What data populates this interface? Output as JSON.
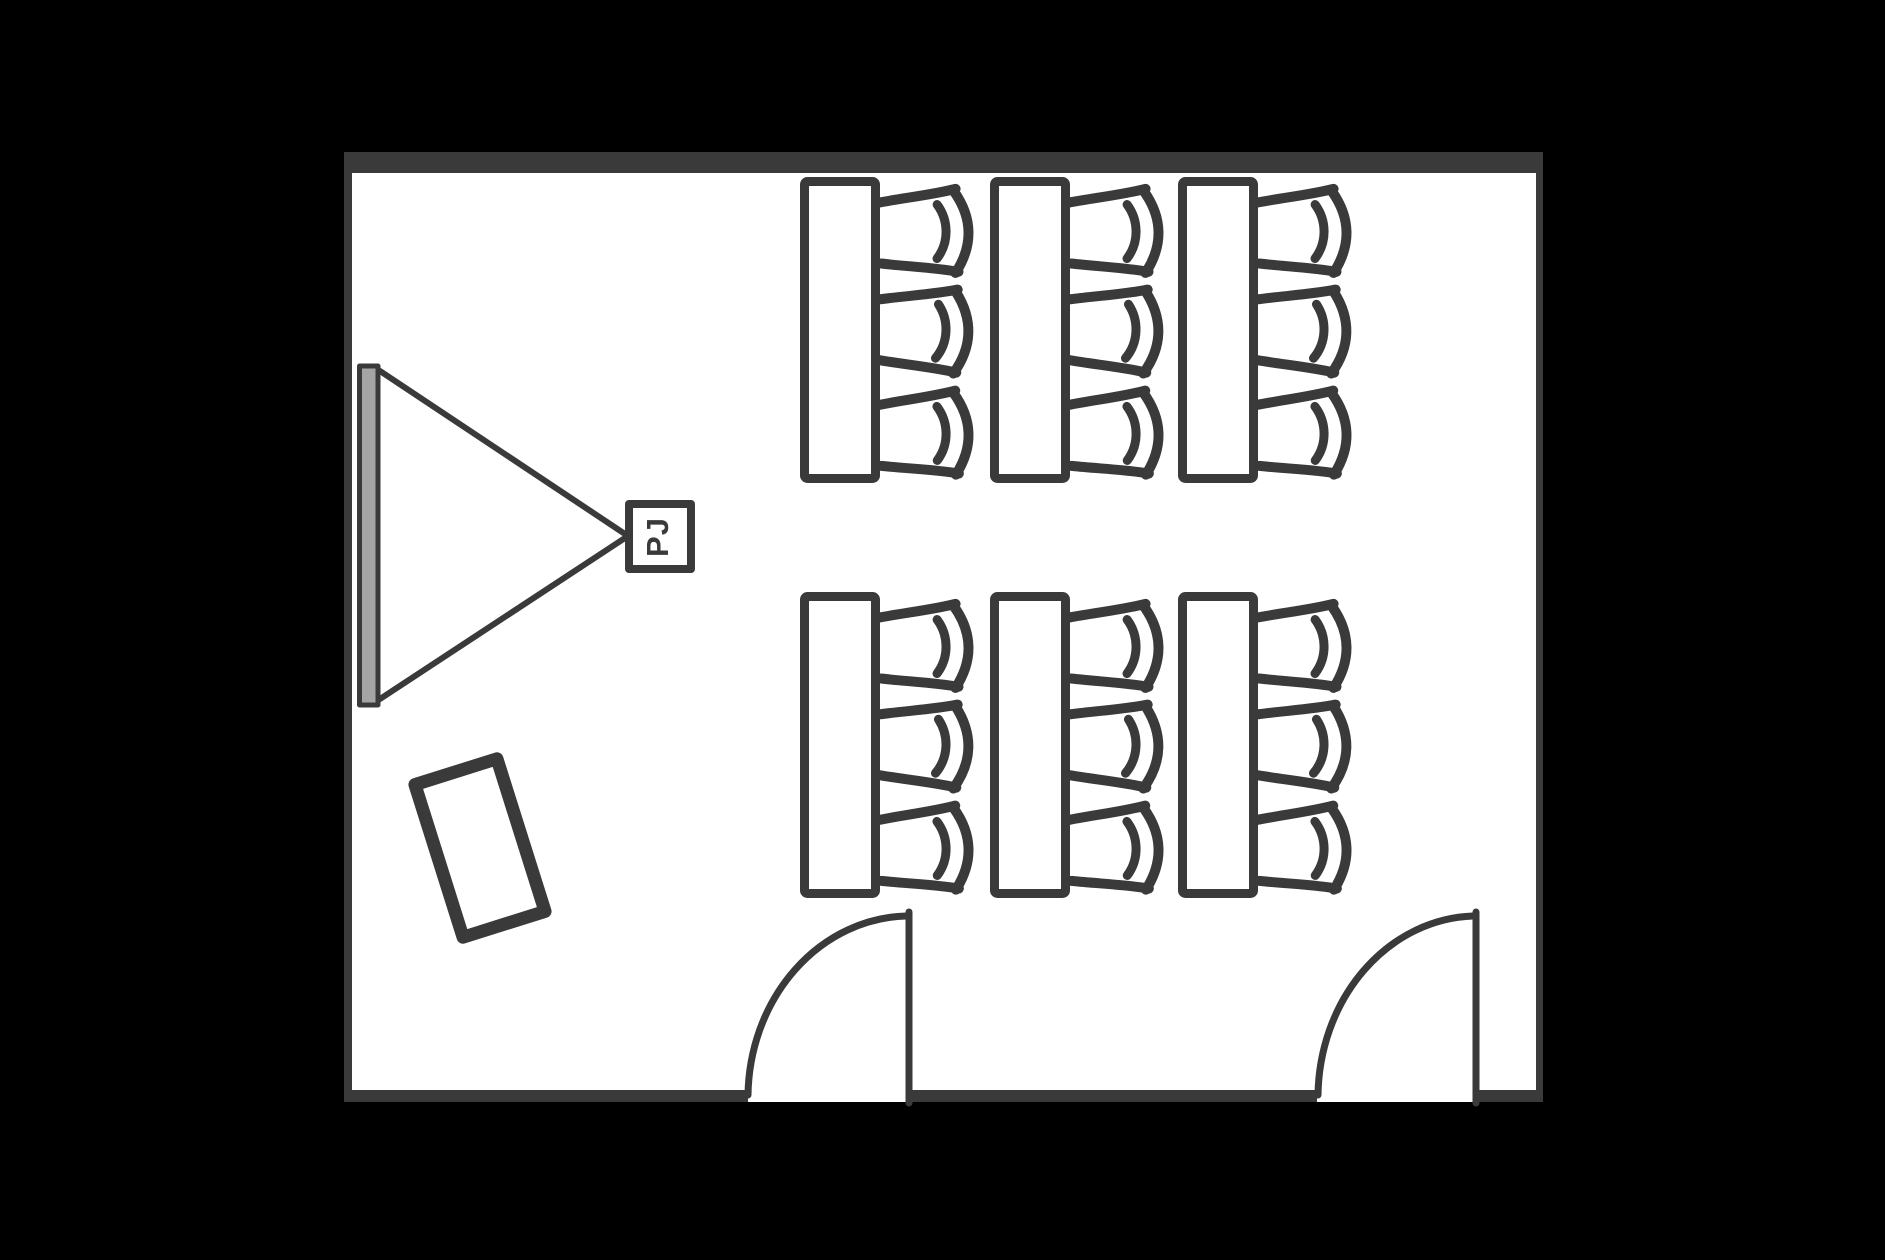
{
  "floorplan": {
    "projector": {
      "label": "PJ"
    },
    "colors": {
      "background": "#000000",
      "wall": "#3a3a3a",
      "floor": "#ffffff",
      "screen": "#a5a5a5"
    },
    "inventory": {
      "tables": 6,
      "chairs_per_table": 3,
      "doors": 2,
      "screens": 1,
      "projectors": 1,
      "podiums": 1
    }
  }
}
